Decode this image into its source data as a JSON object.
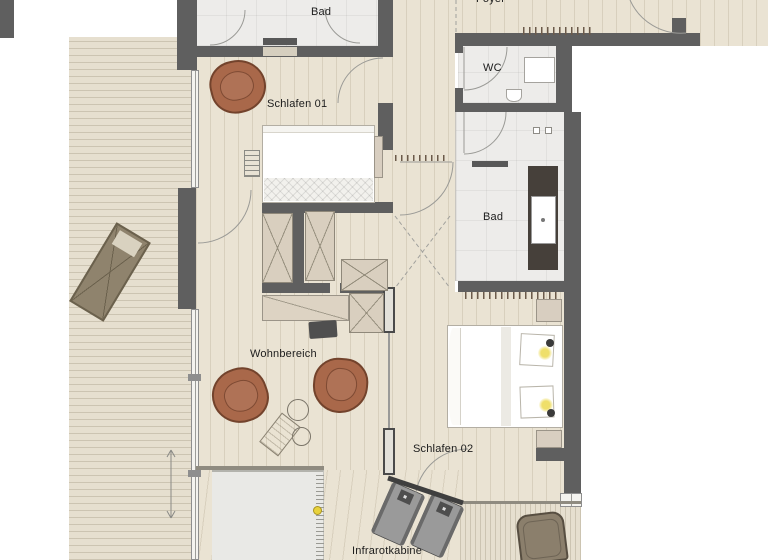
{
  "plan": {
    "labels": {
      "bad_top": "Bad",
      "foyer": "Foyer",
      "wc": "WC",
      "schlafen01": "Schlafen 01",
      "bad_right": "Bad",
      "wohnbereich": "Wohnbereich",
      "schlafen02": "Schlafen 02",
      "infrarotkabine": "Infrarotkabine"
    }
  },
  "colors": {
    "wall": "#5f5f5f",
    "wood": "#eae3d3",
    "deck": "#e6dfcf",
    "tile": "#edecea",
    "dark-tile": "#46403a",
    "accent-chair": "#a9684a",
    "lamp-glow": "#efdf6a"
  }
}
